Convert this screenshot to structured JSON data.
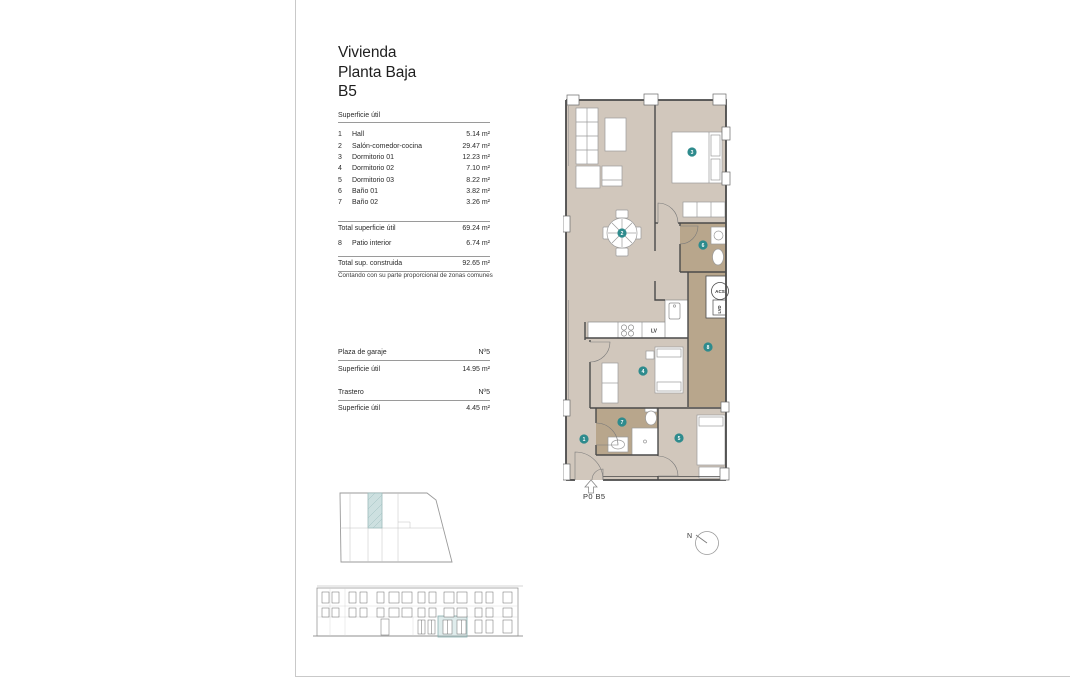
{
  "title": {
    "lines": [
      "Vivienda",
      "Planta Baja",
      "B5"
    ]
  },
  "surface": {
    "header": "Superficie útil",
    "rows": [
      {
        "num": "1",
        "label": "Hall",
        "value": "5.14 m²"
      },
      {
        "num": "2",
        "label": "Salón-comedor-cocina",
        "value": "29.47 m²"
      },
      {
        "num": "3",
        "label": "Dormitorio 01",
        "value": "12.23 m²"
      },
      {
        "num": "4",
        "label": "Dormitorio 02",
        "value": "7.10 m²"
      },
      {
        "num": "5",
        "label": "Dormitorio 03",
        "value": "8.22 m²"
      },
      {
        "num": "6",
        "label": "Baño 01",
        "value": "3.82 m²"
      },
      {
        "num": "7",
        "label": "Baño 02",
        "value": "3.26 m²"
      }
    ],
    "total_util": {
      "label": "Total superficie útil",
      "value": "69.24 m²"
    },
    "patio": {
      "num": "8",
      "label": "Patio interior",
      "value": "6.74 m²"
    },
    "total_built": {
      "label": "Total sup. construida",
      "value": "92.65 m²"
    },
    "note": "Contando con su parte proporcional de zonas comunes"
  },
  "garage": {
    "plaza_label": "Plaza de garaje",
    "plaza_value": "Nº5",
    "plaza_area_label": "Superficie útil",
    "plaza_area_value": "14.95 m²",
    "trastero_label": "Trastero",
    "trastero_value": "Nº5",
    "trastero_area_label": "Superficie útil",
    "trastero_area_value": "4.45 m²"
  },
  "plan": {
    "label": "P0 B5",
    "acs": "ACS",
    "lvd": "LVD",
    "lv": "LV",
    "markers": [
      {
        "num": "1",
        "room": "Hall"
      },
      {
        "num": "2",
        "room": "Salón-comedor-cocina"
      },
      {
        "num": "3",
        "room": "Dormitorio 01"
      },
      {
        "num": "4",
        "room": "Dormitorio 02"
      },
      {
        "num": "5",
        "room": "Dormitorio 03"
      },
      {
        "num": "6",
        "room": "Baño 01"
      },
      {
        "num": "7",
        "room": "Baño 02"
      },
      {
        "num": "8",
        "room": "Patio interior"
      }
    ],
    "colors": {
      "floor": "#d1c7bc",
      "wet": "#b8a68c",
      "marker": "#2e8b8d",
      "highlight": "#cde0e0",
      "elev_highlight": "#b9d4d4"
    }
  },
  "compass": {
    "label": "N"
  }
}
